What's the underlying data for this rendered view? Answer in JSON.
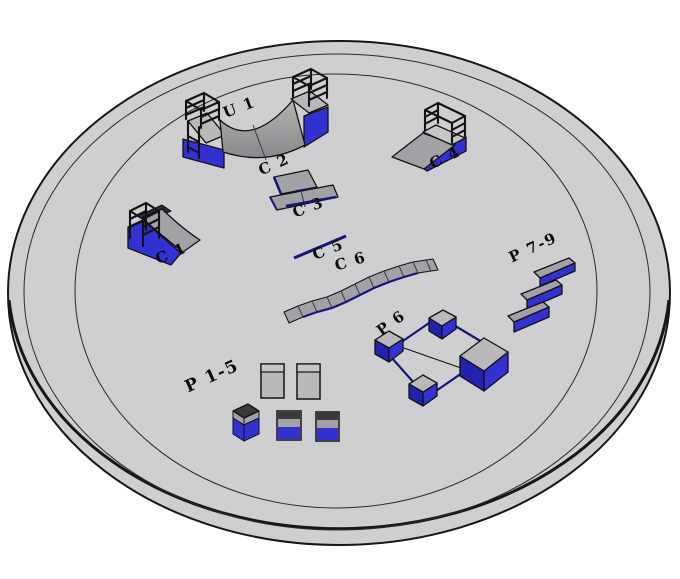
{
  "scene": {
    "background": "#ffffff",
    "ground_fill": "#d3d3d5",
    "palette": {
      "blue": "#3232d4",
      "blue_dark": "#2222b0",
      "navy_rail": "#16167a",
      "gray_surface": "#a2a2a6",
      "gray_light": "#b9b9bb",
      "gray_deck": "#c6c6c8",
      "dark_gray": "#3a3a3c",
      "outline": "#121212",
      "label_color": "#0b0b0b"
    },
    "obstacles": [
      {
        "id": "u1",
        "label": "U 1"
      },
      {
        "id": "c1",
        "label": "C 1"
      },
      {
        "id": "c2",
        "label": "C 2"
      },
      {
        "id": "c3",
        "label": "C 3"
      },
      {
        "id": "c4",
        "label": "C 4"
      },
      {
        "id": "c5",
        "label": "C 5"
      },
      {
        "id": "c6",
        "label": "C 6"
      },
      {
        "id": "p1_5",
        "label": "P 1-5"
      },
      {
        "id": "p6",
        "label": "P 6"
      },
      {
        "id": "p7_9",
        "label": "P 7-9"
      }
    ]
  }
}
